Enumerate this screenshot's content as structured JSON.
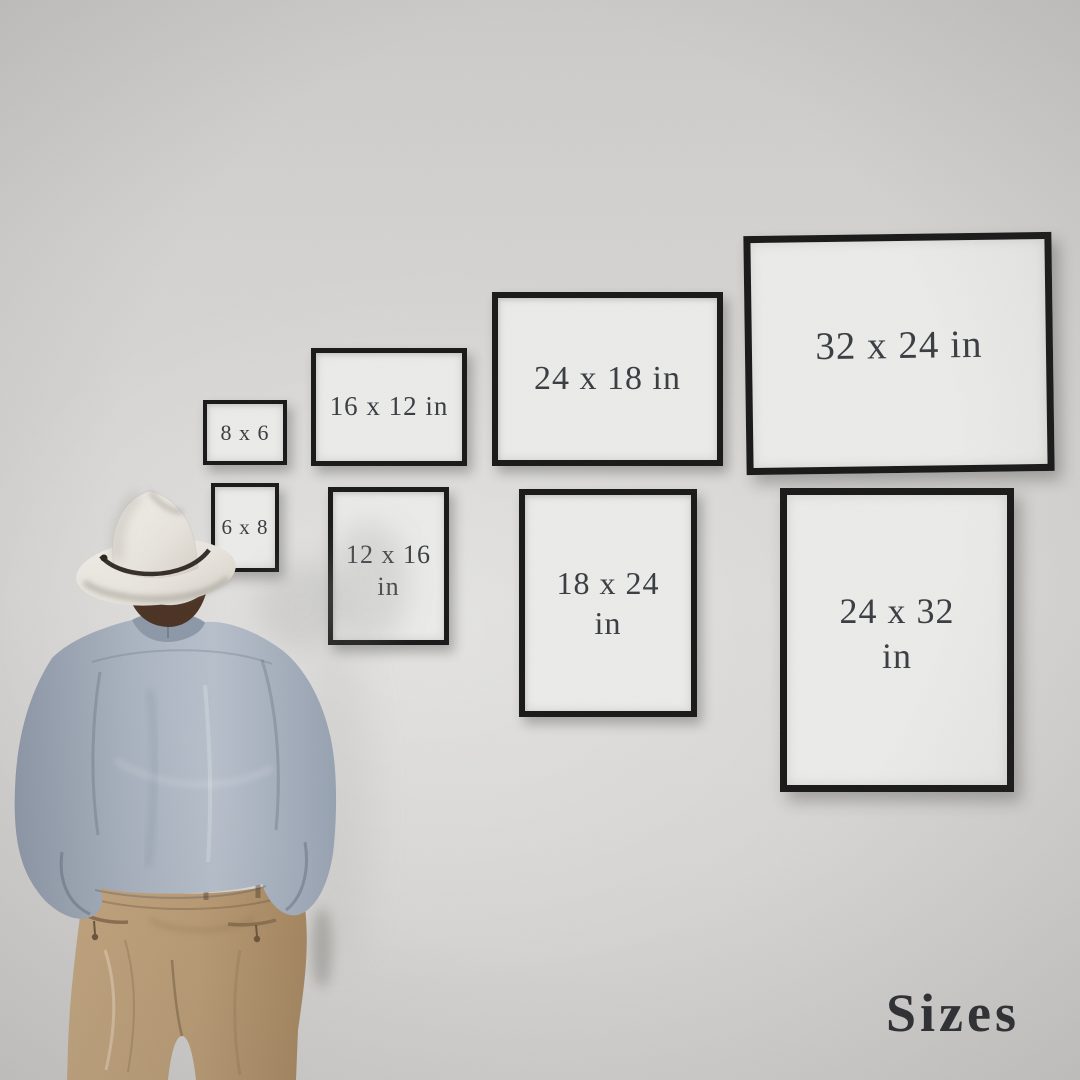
{
  "frames": [
    {
      "id": "8x6",
      "label": "8 x 6",
      "orientation": "landscape"
    },
    {
      "id": "16x12",
      "label": "16 x 12 in",
      "orientation": "landscape"
    },
    {
      "id": "24x18",
      "label": "24 x 18 in",
      "orientation": "landscape"
    },
    {
      "id": "32x24",
      "label": "32 x 24 in",
      "orientation": "landscape"
    },
    {
      "id": "6x8",
      "label": "6 x 8",
      "orientation": "portrait"
    },
    {
      "id": "12x16",
      "label": "12 x 16 in",
      "orientation": "portrait",
      "line1": "12 x 16",
      "line2": "in"
    },
    {
      "id": "18x24",
      "label": "18 x 24 in",
      "orientation": "portrait",
      "line1": "18 x 24",
      "line2": "in"
    },
    {
      "id": "24x32",
      "label": "24 x 32 in",
      "orientation": "portrait",
      "line1": "24 x 32",
      "line2": "in"
    }
  ],
  "watermark": {
    "label": "Sizes"
  },
  "colors": {
    "wall": "#d4d3d1",
    "frame_border": "#171717",
    "frame_matte": "#ebebe9",
    "label_text": "#383c40",
    "watermark_text": "#2a2c30",
    "shirt": "#a9b3c0",
    "pants": "#bb9c74",
    "hat": "#e9e5de",
    "hat_band": "#2a221d",
    "hair": "#4a3122"
  }
}
